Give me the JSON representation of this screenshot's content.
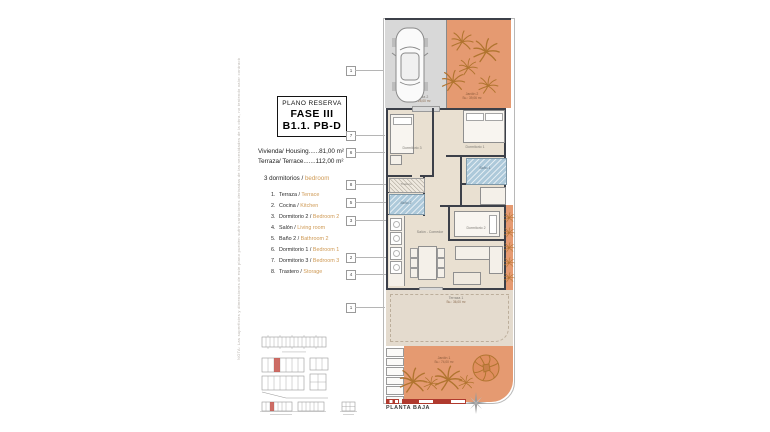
{
  "disclaimer": "NOTA: Las superficies y dimensiones de este plano pueden sufrir variaciones derivadas de las necesidades de la obra, no teniendo valor contractual.",
  "title_box": {
    "kicker": "PLANO RESERVA",
    "phase": "FASE III",
    "unit": "B1.1. PB-D"
  },
  "areas": {
    "housing": "Vivienda/ Housing......81,00 m²",
    "terrace": "Terraza/ Terrace.......112,00 m²"
  },
  "bedrooms": {
    "es": "3 dormitorios /",
    "en": "bedroom"
  },
  "legend": [
    {
      "num": "1.",
      "es": "Terraza /",
      "en": "Terrace"
    },
    {
      "num": "2.",
      "es": "Cocina /",
      "en": "Kitchen"
    },
    {
      "num": "3.",
      "es": "Dormitorio 2 /",
      "en": "Bedroom 2"
    },
    {
      "num": "4.",
      "es": "Salón /",
      "en": "Living room"
    },
    {
      "num": "5.",
      "es": "Baño 2 /",
      "en": "Bathroom 2"
    },
    {
      "num": "6.",
      "es": "Dormitorio 1 /",
      "en": "Bedroom 1"
    },
    {
      "num": "7.",
      "es": "Dormitorio 3 /",
      "en": "Bedroom 3"
    },
    {
      "num": "8.",
      "es": "Trastero /",
      "en": "Storage"
    }
  ],
  "callouts": [
    "1",
    "7",
    "6",
    "8",
    "5",
    "3",
    "2",
    "4",
    "1"
  ],
  "plan": {
    "jardin2": {
      "name": "Jardín 2",
      "area": "Su.: 39,06 m²"
    },
    "terraza2": {
      "name": "Terraza 2",
      "area": "Su.: 25,00 m²"
    },
    "rooms": {
      "dorm3": "Dormitorio 3",
      "dorm1": "Dormitorio 1",
      "bano1": "Baño 1",
      "dorm2": "Dormitorio 2",
      "salon": "Salón - Comedor",
      "bano2": "Baño 2",
      "trastero": "Trastero"
    },
    "terraza1": {
      "name": "Terraza 1",
      "area": "Su.: 36,00 m²"
    },
    "jardin1": {
      "name": "Jardín 1",
      "area": "Su.: 74,00 m²"
    },
    "floor_label": "PLANTA BAJA"
  },
  "colors": {
    "accent_orange": "#cf9a55",
    "garden_orange": "#e59a71",
    "wall_dark": "#3c4049",
    "scale_red": "#b03a2e"
  }
}
